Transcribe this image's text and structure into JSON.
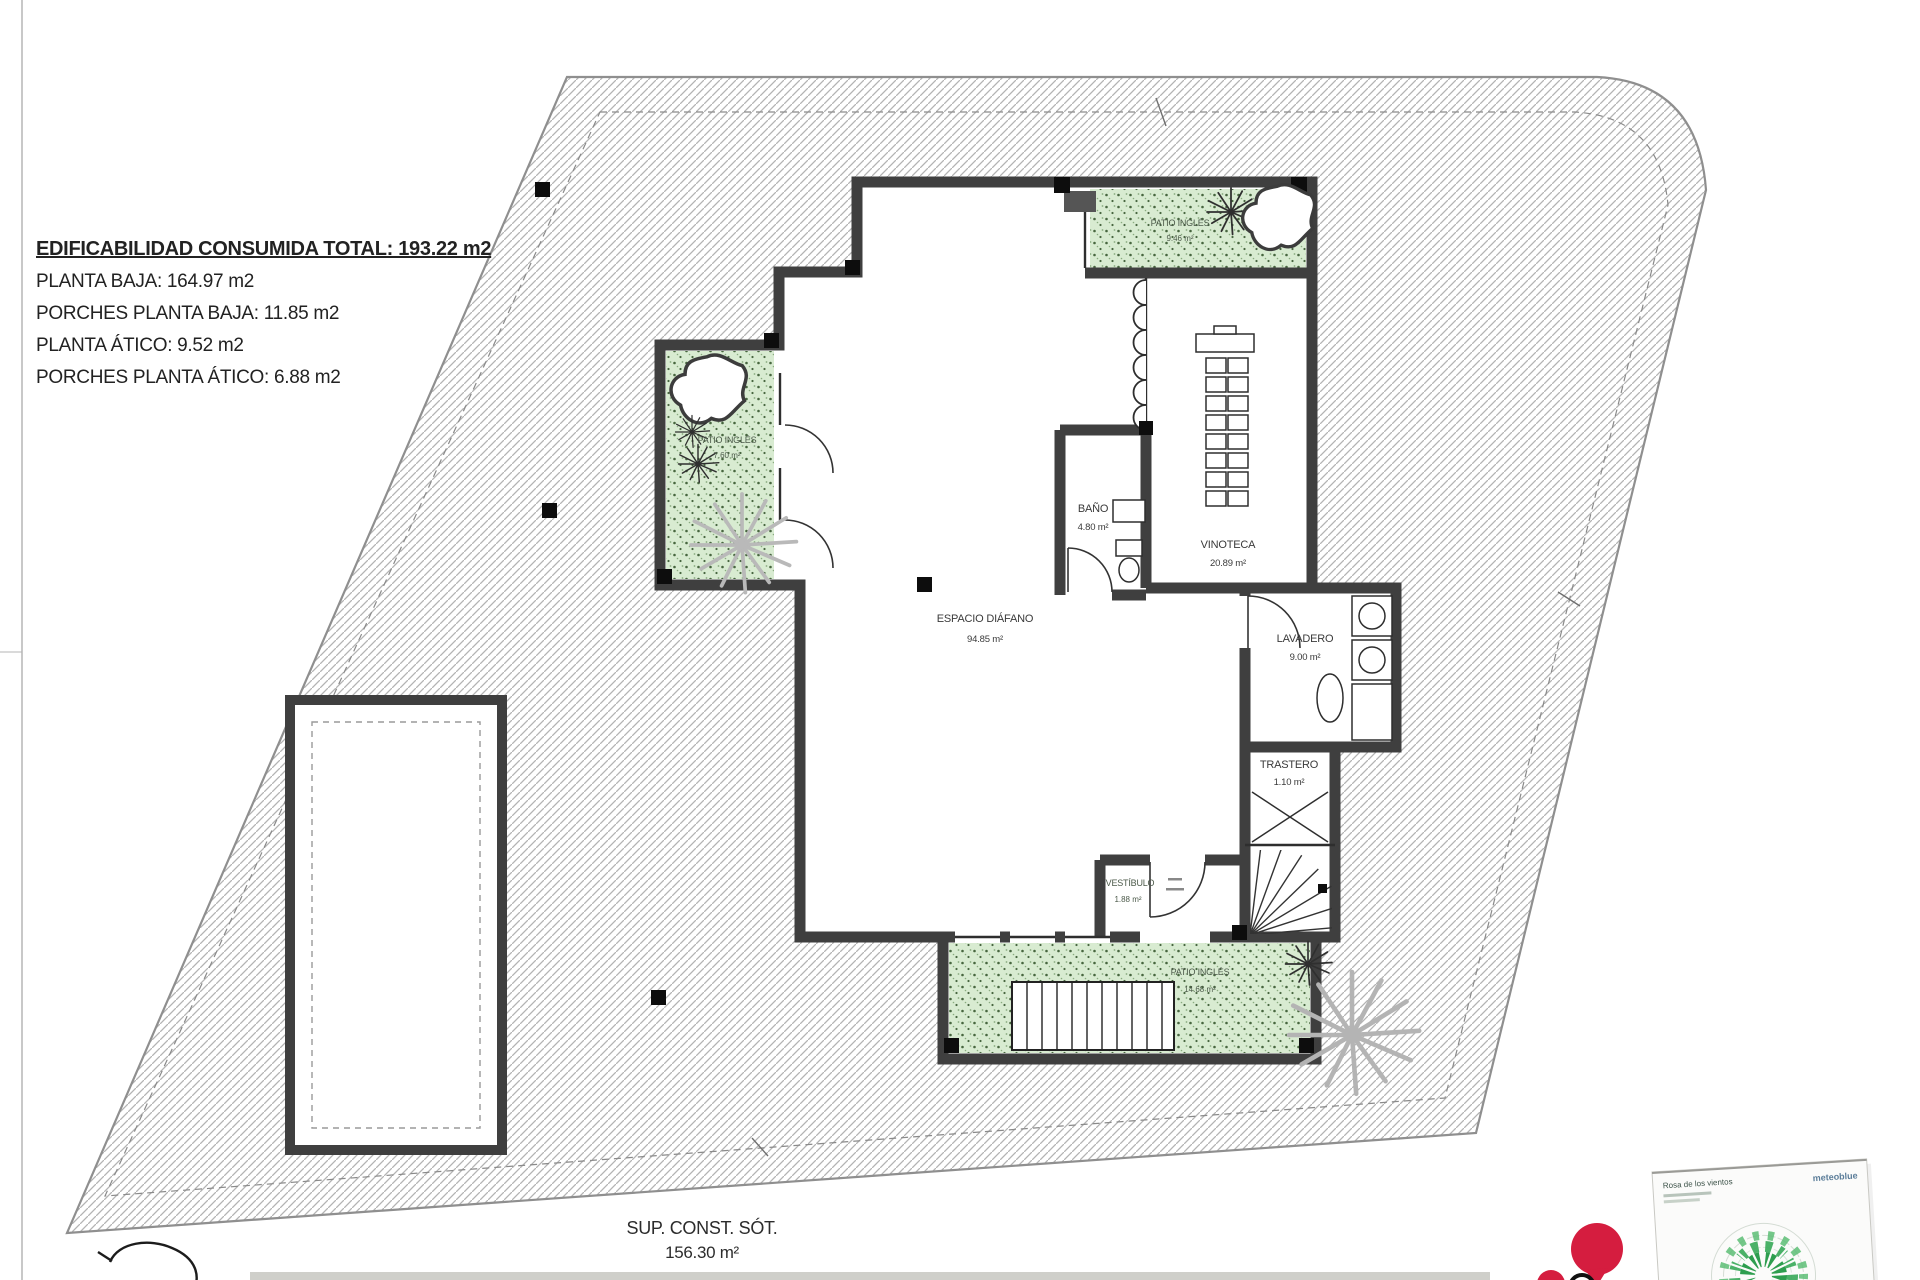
{
  "summary": {
    "title": "EDIFICABILIDAD CONSUMIDA TOTAL: 193.22 m2",
    "lines": [
      "PLANTA BAJA: 164.97 m2",
      "PORCHES PLANTA BAJA: 11.85 m2",
      "PLANTA ÁTICO: 9.52 m2",
      "PORCHES PLANTA ÁTICO: 6.88 m2"
    ]
  },
  "rooms": [
    {
      "name": "ESPACIO DIÁFANO",
      "area": "94.85 m²"
    },
    {
      "name": "BAÑO",
      "area": "4.80 m²"
    },
    {
      "name": "VINOTECA",
      "area": "20.89 m²"
    },
    {
      "name": "LAVADERO",
      "area": "9.00 m²"
    },
    {
      "name": "TRASTERO",
      "area": "1.10 m²"
    },
    {
      "name": "VESTÍBULO",
      "area": "1.88 m²"
    },
    {
      "name": "PATIO INGLÉS",
      "area": "9.46 m²"
    },
    {
      "name": "PATIO INGLÉS",
      "area": "7.60 m²"
    },
    {
      "name": "PATIO INGLÉS",
      "area": "14.68 m²"
    }
  ],
  "footer": {
    "label": "SUP. CONST. SÓT.",
    "area": "156.30 m²"
  },
  "windrose": {
    "title": "Rosa de los vientos",
    "brand": "meteoblue"
  },
  "colors": {
    "wall": "#3f3f3f",
    "hatch_line": "#b3b3b3",
    "patio_green": "#d8ebd1",
    "pin_red": "#d51d3f",
    "rose_green": "#37a958"
  }
}
